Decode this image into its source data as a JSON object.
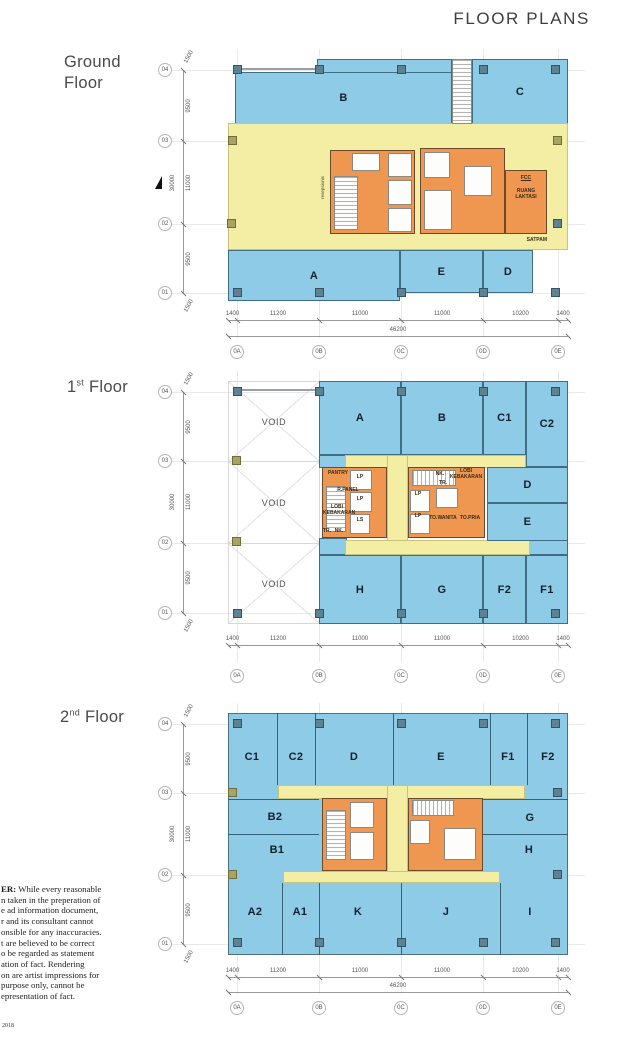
{
  "header": {
    "title": "FLOOR PLANS"
  },
  "grid": {
    "row_bubbles": [
      "04",
      "03",
      "02",
      "01"
    ],
    "col_bubbles": [
      "0A",
      "0B",
      "0C",
      "0D",
      "0E"
    ],
    "v_dims": [
      "1500",
      "9500",
      "11000",
      "9500",
      "1500"
    ],
    "v_total": "30000",
    "h_dims": [
      "1400",
      "11200",
      "11000",
      "11000",
      "10200",
      "1400"
    ],
    "h_total": "46200"
  },
  "ground": {
    "label_l1": "Ground",
    "label_l2": "Floor",
    "zones": {
      "a": "A",
      "b": "B",
      "c": "C",
      "d": "D",
      "e": "E"
    },
    "rooms": {
      "resepsionis": "resepsionis",
      "fcc": "FCC",
      "ruang_laktasi": "RUANG LAKTASI",
      "satpam": "SATPAM"
    }
  },
  "first": {
    "label_num": "1",
    "label_sup": "st",
    "label_word": "Floor",
    "void": "VOID",
    "zones": {
      "a": "A",
      "b": "B",
      "c1": "C1",
      "c2": "C2",
      "d": "D",
      "e": "E",
      "f1": "F1",
      "f2": "F2",
      "g": "G",
      "h": "H"
    },
    "rooms": {
      "pantry": "PANTRY",
      "r_panel": "R.PANEL",
      "lobi_kebakaran": "LOBI KEBAKARAN",
      "lp": "LP",
      "ls": "LS",
      "tr": "TR.",
      "nk": "NK.",
      "to_wanita": "TO.WANITA",
      "to_pria": "TO.PRIA"
    }
  },
  "second": {
    "label_num": "2",
    "label_sup": "nd",
    "label_word": "Floor",
    "zones": {
      "c1": "C1",
      "c2": "C2",
      "d": "D",
      "e": "E",
      "f1": "F1",
      "f2": "F2",
      "b2": "B2",
      "b1": "B1",
      "g": "G",
      "h": "H",
      "a2": "A2",
      "a1": "A1",
      "k": "K",
      "j": "J",
      "i": "I"
    }
  },
  "disclaimer": {
    "bold_prefix": "ER:",
    "line1_rest": " While every reasonable",
    "lines": [
      "n taken in the preperation of",
      "e ad information document,",
      "r and its consultant cannot",
      "onsible for any inaccuracies.",
      "t are believed to be correct",
      "o be regarded as statement",
      "ation of fact. Rendering",
      "on are artist impressions for",
      "purpose only, cannot be",
      "epresentation of fact."
    ]
  },
  "footer": {
    "year": "2018"
  },
  "colors": {
    "zone_blue": "#8ecbe7",
    "corridor_yellow": "#f4eea4",
    "core_orange": "#ef9750",
    "column_teal": "#5d8292",
    "column_olive": "#a7a55f"
  }
}
